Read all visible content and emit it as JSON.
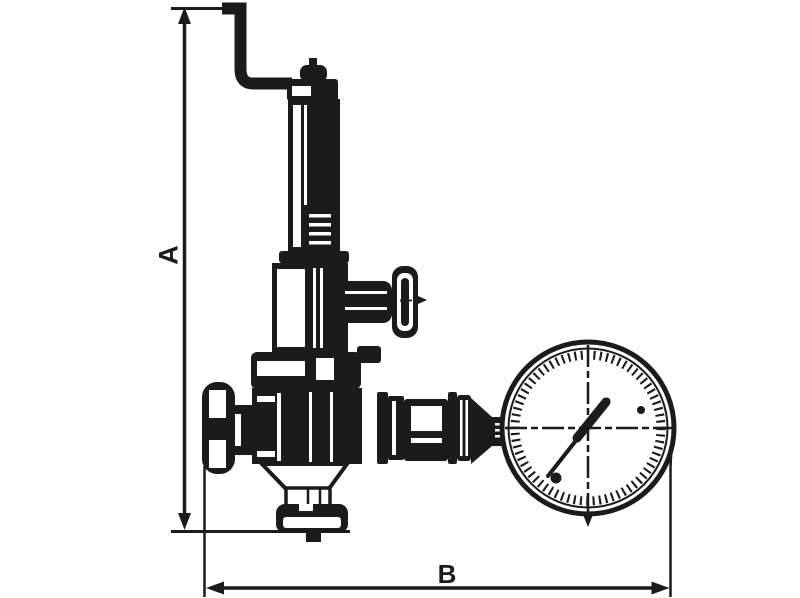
{
  "canvas": {
    "background_color": "#ffffff",
    "line_color": "#1b1b1b"
  },
  "drawing": {
    "description": "Technical dimension drawing of a safety relief valve with top test lever, side handwheel, bottom outlet flange and pressure gauge",
    "dimension_a_label": "A",
    "dimension_b_label": "B"
  }
}
